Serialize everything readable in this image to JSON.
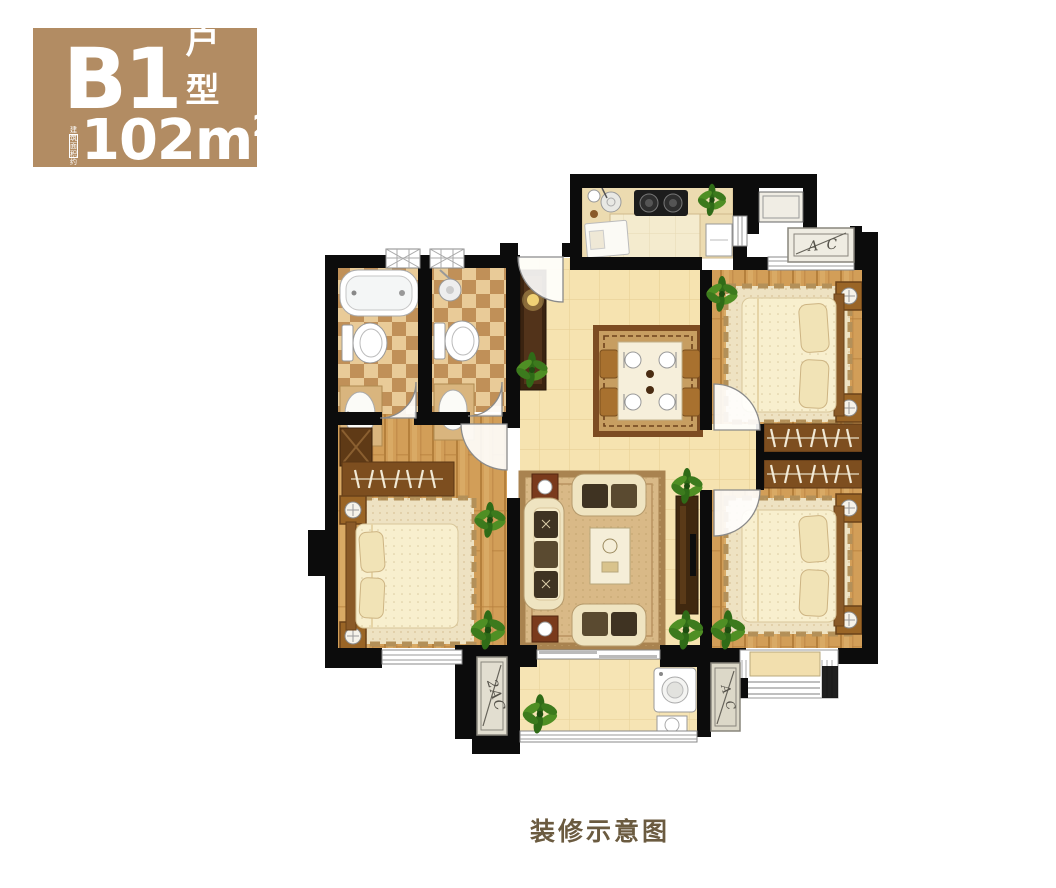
{
  "badge": {
    "unit_code": "B1",
    "unit_type_label": "户型",
    "area_note_line1": "建 筑",
    "area_note_line2": "面积约",
    "area_value": "102m",
    "area_superscript": "2",
    "background_color": "#b28c63",
    "text_color": "#ffffff"
  },
  "caption": {
    "text": "装修示意图",
    "color": "#6b5b40"
  },
  "plan": {
    "labels": {
      "ac_top_right": "A C",
      "ac_bottom_left": "2AC",
      "ac_bottom_right": "A C"
    },
    "colors": {
      "wall": "#0c0c0c",
      "tile_floor": "#f6e3b0",
      "wood_floor": "#d29e58",
      "bath_tile": "#dbb27f",
      "bedroom_rug": "#eee2c2",
      "dining_rug": "#c79e61",
      "plant": "#2f6b17",
      "dark_cabinet": "#3a2310"
    }
  }
}
